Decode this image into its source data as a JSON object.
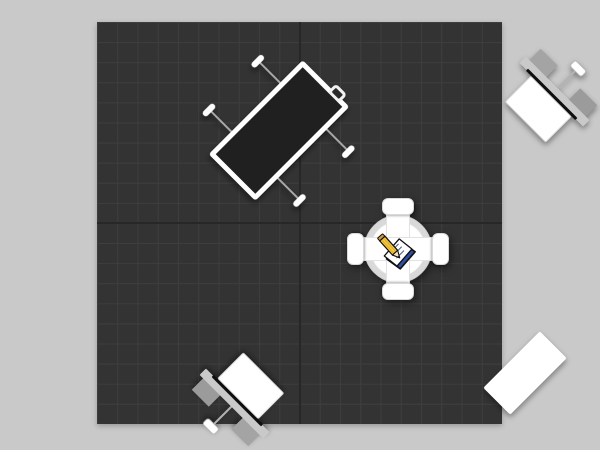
{
  "scene": {
    "description": "Top-down plan view of a 20x20 island trade-show booth rendering",
    "grid": {
      "columns": 20,
      "rows": 20
    }
  },
  "colors": {
    "bg": "#c9c9c9",
    "floor": "#333333",
    "grid": "#3e3e3e",
    "seam": "#272727",
    "white": "#ffffff",
    "panel-dark": "#202020",
    "gray-light": "#c9c9c9",
    "monitor": "#0e0e0e",
    "logo-blue": "#2d4f9e",
    "pencil-yellow": "#f4c63c"
  },
  "floor": {
    "x": 97,
    "y": 22,
    "width": 405,
    "height": 402
  },
  "items": [
    {
      "id": "display-table-nw",
      "label": "rectangular display counter with feet",
      "cx": 182,
      "cy": 108,
      "w": 66,
      "h": 133,
      "rot": 45
    },
    {
      "id": "workstation-ne",
      "label": "monitor workstation counter",
      "cx": 455,
      "cy": 72,
      "w": 80,
      "h": 48,
      "rot": 45
    },
    {
      "id": "center-kiosk",
      "label": "four-sided center kiosk with logo disc",
      "cx": 300.5,
      "cy": 226.5,
      "w": 102,
      "h": 102,
      "rot": 0
    },
    {
      "id": "workstation-sw",
      "label": "monitor workstation counter",
      "cx": 140,
      "cy": 379,
      "w": 80,
      "h": 48,
      "rot": 225
    },
    {
      "id": "table-se",
      "label": "plain white table",
      "cx": 428,
      "cy": 351,
      "w": 38,
      "h": 80,
      "rot": 45
    }
  ],
  "logo": {
    "label": "notebook-and-pencil logo",
    "book_cover_color": "#2d4f9e",
    "page_color": "#ffffff",
    "pencil_color": "#f4c63c"
  }
}
